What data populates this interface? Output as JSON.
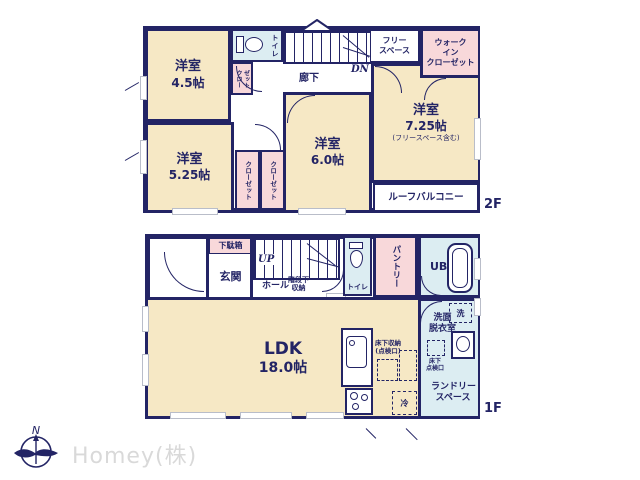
{
  "colors": {
    "wall": "#232465",
    "cream": "#f6e8c5",
    "pink": "#f8d8da",
    "blue": "#dcedf2",
    "window_gray": "#b9bdc9",
    "watermark_gray": "#d9d9d9"
  },
  "floor2": {
    "label": "2F",
    "r45": {
      "name": "洋室",
      "size": "4.5帖"
    },
    "r525": {
      "name": "洋室",
      "size": "5.25帖"
    },
    "r60": {
      "name": "洋室",
      "size": "6.0帖"
    },
    "r725": {
      "name": "洋室",
      "size": "7.25帖",
      "note": "(フリースペース含む)"
    },
    "toilet": "トイレ",
    "closet_small": {
      "c1": "クロー",
      "c2": "ゼット"
    },
    "closet_a": "クローゼット",
    "closet_b": "クローゼット",
    "free_space": [
      "フリー",
      "スペース"
    ],
    "wic": [
      "ウォーク",
      "イン",
      "クローゼット"
    ],
    "corridor": "廊下",
    "dn": "DN",
    "balcony": "ルーフバルコニー"
  },
  "floor1": {
    "label": "1F",
    "ldk": {
      "name": "LDK",
      "size": "18.0帖"
    },
    "getabako": "下駄箱",
    "genkan": "玄関",
    "up": "UP",
    "hall": "ホール",
    "under_stairs": [
      "階段下",
      "収納"
    ],
    "toilet": "トイレ",
    "niche": "ニッチ",
    "storage": "収納",
    "pantry": "パントリー",
    "ub": "UB",
    "washroom": [
      "洗面",
      "脱衣室"
    ],
    "washer": "洗",
    "hatch": [
      "床下",
      "点検口"
    ],
    "laundry": [
      "ランドリー",
      "スペース"
    ],
    "floor_storage": [
      "床下収納",
      "(点検口)"
    ],
    "fridge": "冷"
  },
  "footer": {
    "watermark": "Homey(株)",
    "north": "N"
  }
}
